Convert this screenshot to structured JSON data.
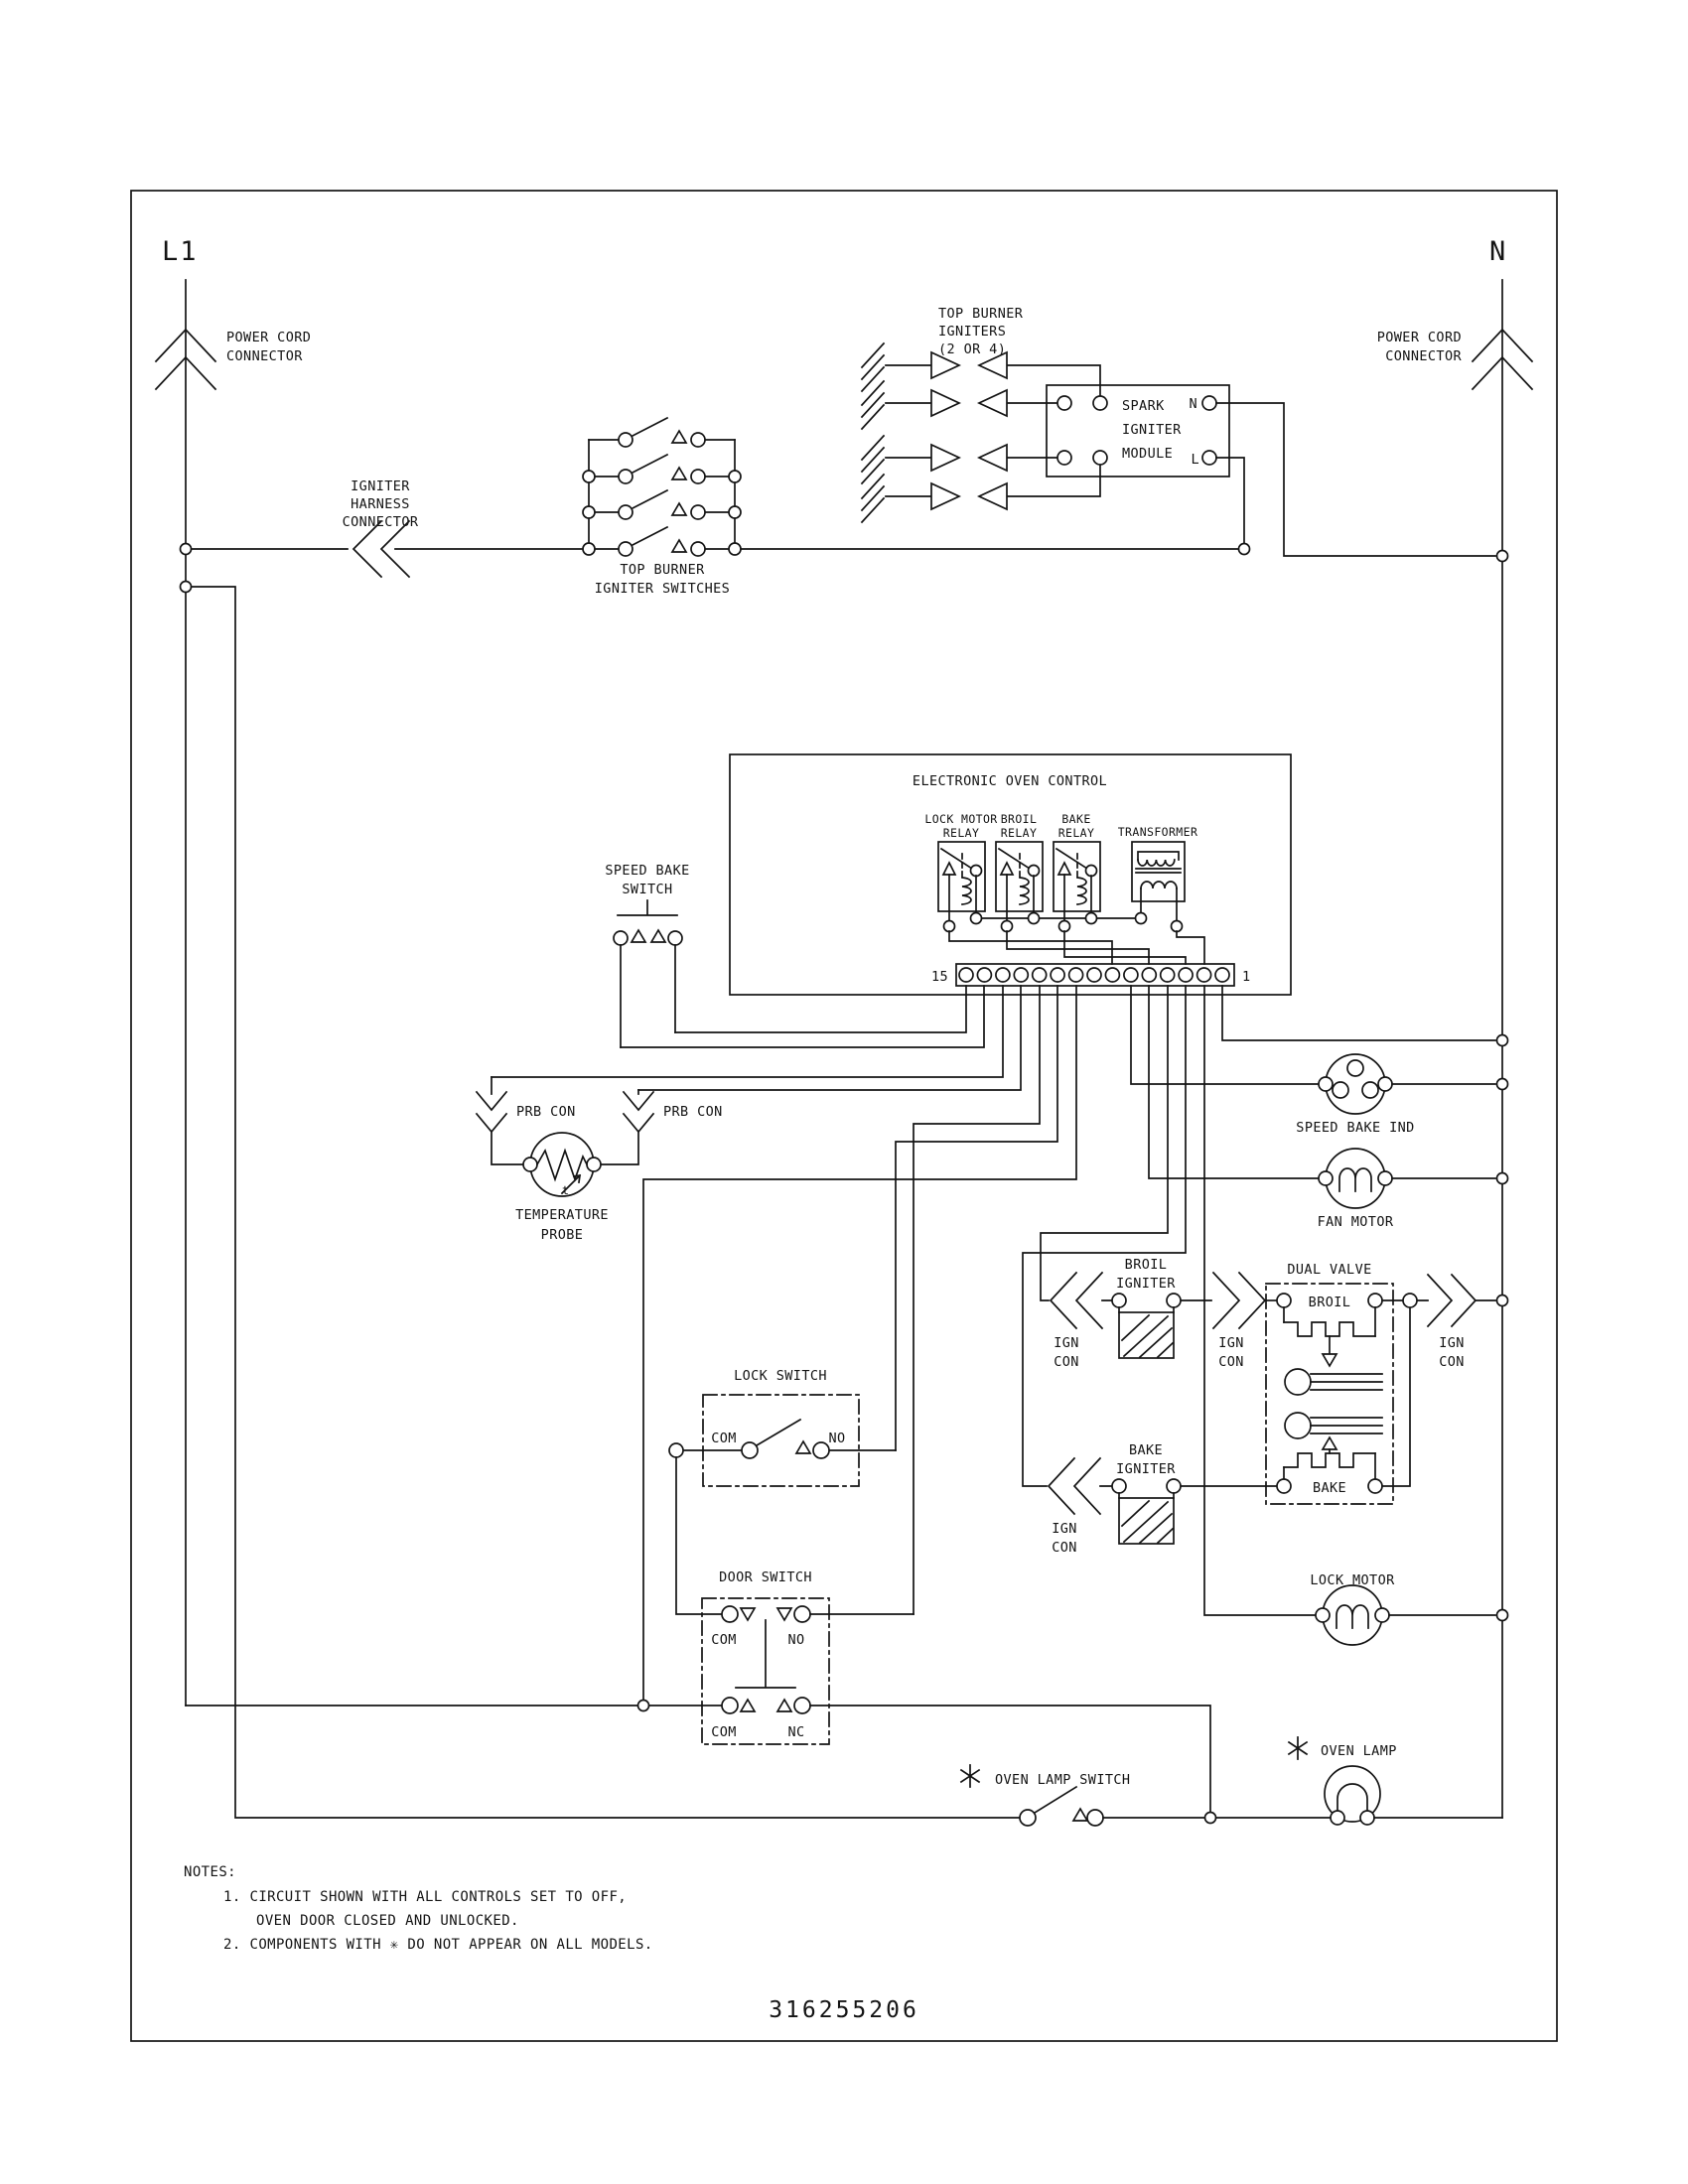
{
  "diagram": {
    "part_number": "316255206",
    "left_rail": "L1",
    "right_rail": "N",
    "power_cord_connector": {
      "line1": "POWER CORD",
      "line2": "CONNECTOR"
    },
    "igniter_harness_connector": {
      "line1": "IGNITER",
      "line2": "HARNESS",
      "line3": "CONNECTOR"
    },
    "top_burner_igniters": {
      "line1": "TOP BURNER",
      "line2": "IGNITERS",
      "line3": "(2 OR 4)"
    },
    "top_burner_igniter_switches": {
      "line1": "TOP BURNER",
      "line2": "IGNITER SWITCHES"
    },
    "spark_igniter_module": {
      "line1": "SPARK",
      "line2": "IGNITER",
      "line3": "MODULE",
      "n": "N",
      "l": "L"
    },
    "eoc": {
      "title": "ELECTRONIC OVEN CONTROL",
      "relay1": {
        "line1": "LOCK MOTOR",
        "line2": "RELAY"
      },
      "relay2": {
        "line1": "BROIL",
        "line2": "RELAY"
      },
      "relay3": {
        "line1": "BAKE",
        "line2": "RELAY"
      },
      "transformer": "TRANSFORMER",
      "pin_left": "15",
      "pin_right": "1"
    },
    "speed_bake_switch": {
      "line1": "SPEED BAKE",
      "line2": "SWITCH"
    },
    "prb_con": "PRB CON",
    "temperature_probe": {
      "line1": "TEMPERATURE",
      "line2": "PROBE",
      "t": "t"
    },
    "speed_bake_ind": "SPEED BAKE IND",
    "fan_motor": "FAN MOTOR",
    "broil_igniter": {
      "line1": "BROIL",
      "line2": "IGNITER"
    },
    "bake_igniter": {
      "line1": "BAKE",
      "line2": "IGNITER"
    },
    "ign_con": {
      "line1": "IGN",
      "line2": "CON"
    },
    "dual_valve": {
      "title": "DUAL VALVE",
      "broil": "BROIL",
      "bake": "BAKE"
    },
    "lock_switch": {
      "title": "LOCK SWITCH",
      "com": "COM",
      "no": "NO"
    },
    "door_switch": {
      "title": "DOOR SWITCH",
      "com": "COM",
      "no": "NO",
      "nc": "NC"
    },
    "lock_motor": "LOCK MOTOR",
    "oven_lamp_switch": "OVEN LAMP SWITCH",
    "oven_lamp": "OVEN LAMP",
    "notes": {
      "heading": "NOTES:",
      "n1a": "1.  CIRCUIT SHOWN WITH ALL CONTROLS SET TO OFF,",
      "n1b": "OVEN DOOR CLOSED AND UNLOCKED.",
      "n2": "2.  COMPONENTS WITH  ✳  DO NOT APPEAR ON ALL MODELS."
    }
  }
}
